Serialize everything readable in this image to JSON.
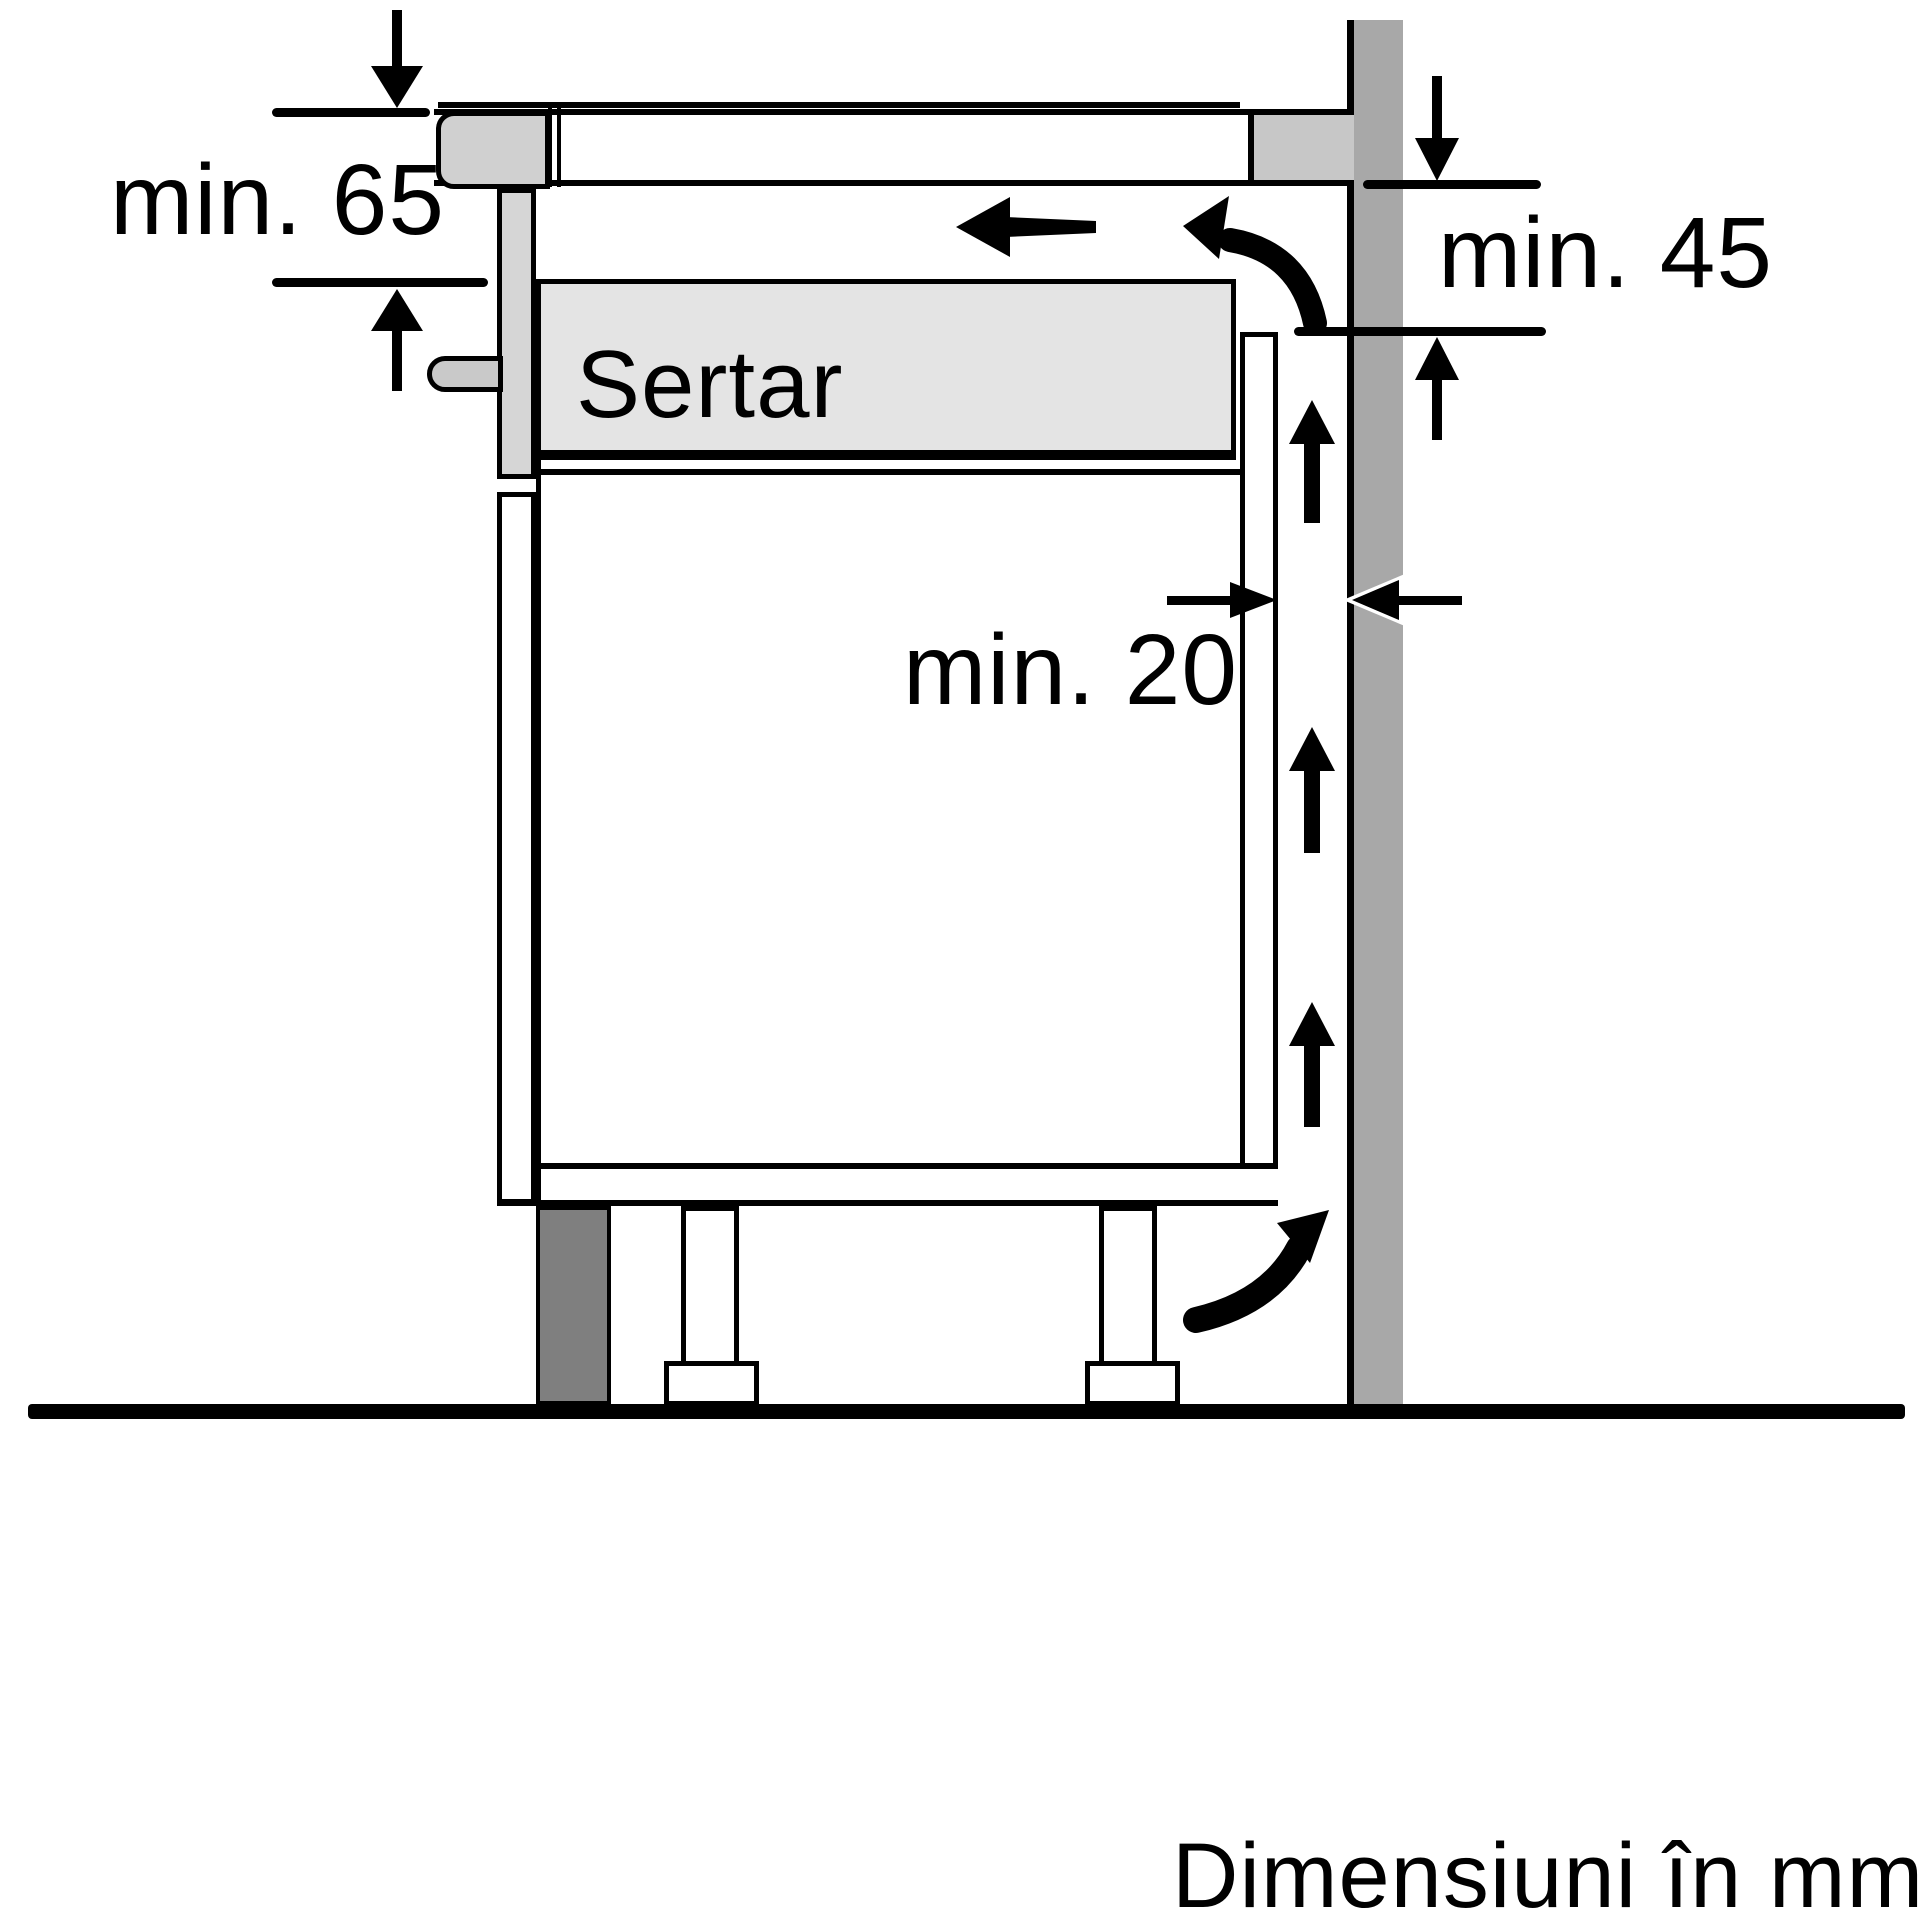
{
  "labels": {
    "clearance_hob_depth": "min. 65",
    "clearance_back_vent": "min. 45",
    "clearance_wall_gap": "min. 20",
    "drawer": "Sertar",
    "units_note": "Dimensiuni în mm"
  },
  "colors": {
    "background": "#ffffff",
    "line": "#000000",
    "wall": "#a8a8a8",
    "worktop_end_block": "#c7c7c7",
    "hob_trim": "#d0d0d0",
    "side_panel": "#d6d6d6",
    "handle": "#c9c9c9",
    "drawer_fill": "#e4e4e4",
    "plinth": "#7f7f7f",
    "leg": "#ffffff"
  },
  "icons": [
    "down-arrow-icon",
    "up-arrow-icon",
    "left-arrow-icon",
    "right-arrow-icon",
    "airflow-up-arrow-icon",
    "curved-airflow-arrow-icon"
  ]
}
